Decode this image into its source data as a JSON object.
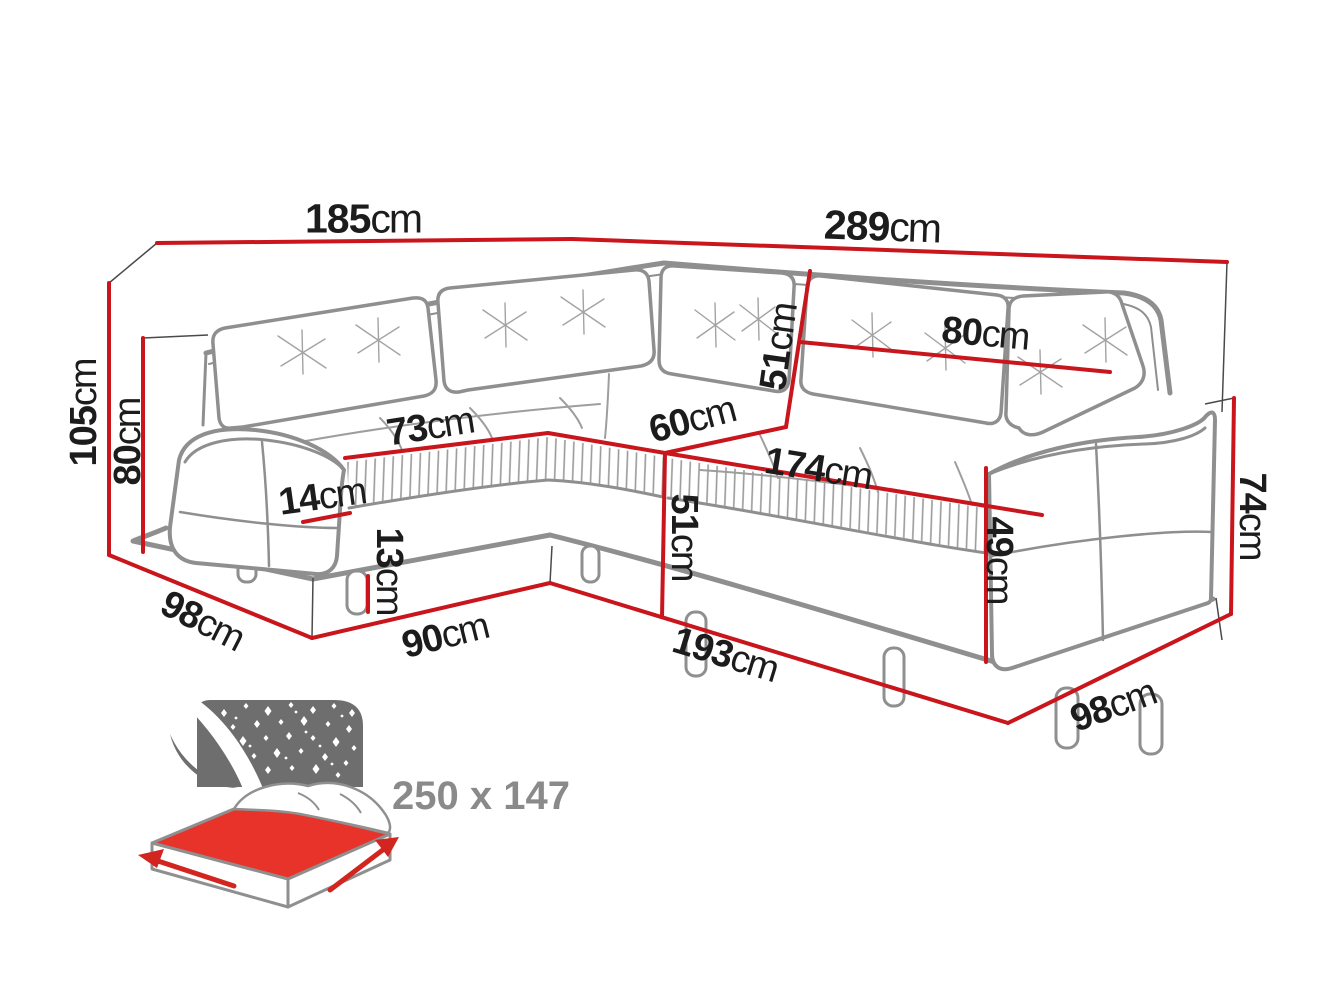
{
  "diagram_title": "corner sofa dimensions",
  "dims": {
    "top_left_width": {
      "value": "185",
      "unit": "cm"
    },
    "top_right_width": {
      "value": "289",
      "unit": "cm"
    },
    "total_height": {
      "value": "105",
      "unit": "cm"
    },
    "back_height": {
      "value": "80",
      "unit": "cm"
    },
    "left_depth": {
      "value": "98",
      "unit": "cm"
    },
    "left_seat_width": {
      "value": "73",
      "unit": "cm"
    },
    "cushion_front_height": {
      "value": "14",
      "unit": "cm"
    },
    "leg_height": {
      "value": "13",
      "unit": "cm"
    },
    "front_left_width": {
      "value": "90",
      "unit": "cm"
    },
    "corner_seat_width": {
      "value": "60",
      "unit": "cm"
    },
    "backrest_height": {
      "value": "51",
      "unit": "cm"
    },
    "right_backrest_width": {
      "value": "80",
      "unit": "cm"
    },
    "right_seat_width": {
      "value": "174",
      "unit": "cm"
    },
    "seat_height": {
      "value": "51",
      "unit": "cm"
    },
    "front_right_width": {
      "value": "193",
      "unit": "cm"
    },
    "arm_inner_height": {
      "value": "49",
      "unit": "cm"
    },
    "arm_height": {
      "value": "74",
      "unit": "cm"
    },
    "right_depth": {
      "value": "98",
      "unit": "cm"
    }
  },
  "bed": {
    "sleeping_area": "250 x 147"
  },
  "colors": {
    "dimension_red": "#c8161c",
    "sketch_gray": "#8f8f8f",
    "extension_dark": "#4a4a4a",
    "text_black": "#1c1c1c",
    "bed_panel_gray": "#6e6e6e",
    "bed_top_red": "#e8332b",
    "size_text_gray": "#8a8a8a"
  }
}
